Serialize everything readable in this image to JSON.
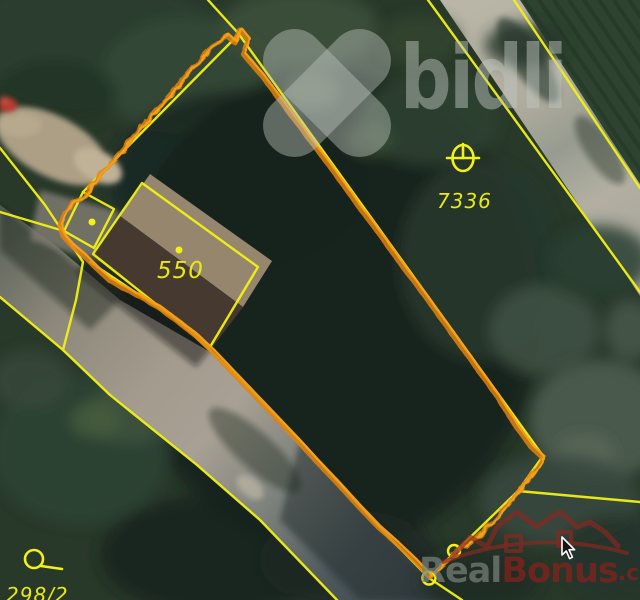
{
  "map": {
    "type": "cadastral-satellite-view",
    "parcel_labels": [
      {
        "text": "550"
      },
      {
        "text": "7336"
      },
      {
        "text": "298/2"
      }
    ],
    "highlighted_parcel": "orange outlined parcel around building 550",
    "colors": {
      "boundary_yellow": "#f2f213",
      "highlight_orange": "#e2820c",
      "label_yellow": "#e9e914"
    }
  },
  "watermarks": {
    "bidli": {
      "text": "bidli"
    },
    "realbonus": {
      "text_real": "Real",
      "text_bonus": "Bonus",
      "text_suffix": ".cz"
    }
  }
}
